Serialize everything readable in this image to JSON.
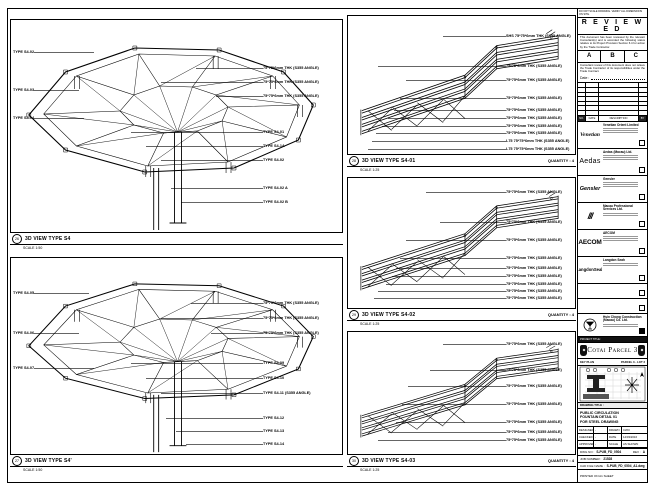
{
  "sheet_note": "DO NOT SCALE DRAWING. VERIFY ALL DIMENSIONS ON SITE.",
  "panels": {
    "big_top": {
      "bubble": "26",
      "caption": "3D VIEW TYPE S4",
      "scale": "SCALE 1:50",
      "left_labels": [
        "TYPE S4-02",
        "TYPE S4-03",
        "TYPE S4-04"
      ],
      "right_labels": [
        "75*75*6mm THK (S355 ANGLE)",
        "75*75*6mm THK (S355 ANGLE)",
        "75*75*6mm THK (S355 ANGLE)",
        "TYPE S4-01",
        "TYPE S4-1A",
        "TYPE S4-02",
        "TYPE S4-02 A",
        "TYPE S4-02 B"
      ]
    },
    "big_bottom": {
      "bubble": "27",
      "caption": "3D VIEW TYPE S4'",
      "scale": "SCALE 1:50",
      "left_labels": [
        "TYPE S4-05",
        "TYPE S4-06",
        "TYPE S4-07"
      ],
      "right_labels": [
        "75*75*6mm THK (S355 ANGLE)",
        "75*75*6mm THK (S355 ANGLE)",
        "75*75*6mm THK (S355 ANGLE)",
        "TYPE S4-09",
        "TYPE S4-10",
        "TYPE S4-11 (S355 ANGLE)",
        "TYPE S4-12",
        "TYPE S4-13",
        "TYPE S4-14"
      ]
    },
    "detail_1": {
      "bubble": "28",
      "caption": "3D VIEW TYPE S4-01",
      "scale": "SCALE 1:25",
      "quantity": "QUANTITY : 4",
      "labels": [
        "SHS 75*75*6mm THK (S355 ANGLE)",
        "75*75*6mm THK (S355 ANGLE)",
        "75*75*6mm THK (S355 ANGLE)",
        "75*75*6mm THK (S355 ANGLE)",
        "75*75*6mm THK (S355 ANGLE)",
        "75*75*6mm THK (S355 ANGLE)",
        "75*75*6mm THK (S355 ANGLE)",
        "75*75*6mm THK (S355 ANGLE)",
        "L75 75*75*6mm THK (S355 ANGLE)",
        "L75 75*75*6mm THK (S355 ANGLE)"
      ]
    },
    "detail_2": {
      "bubble": "29",
      "caption": "3D VIEW TYPE S4-02",
      "scale": "SCALE 1:25",
      "quantity": "QUANTITY : 4",
      "labels": [
        "75*75*6mm THK (S355 ANGLE)",
        "75*75*6mm THK (S355 ANGLE)",
        "75*75*6mm THK (S355 ANGLE)",
        "75*75*6mm THK (S355 ANGLE)",
        "75*75*6mm THK (S355 ANGLE)",
        "75*75*6mm THK (S355 ANGLE)",
        "75*75*6mm THK (S355 ANGLE)",
        "75*75*6mm THK (S355 ANGLE)",
        "75*75*6mm THK (S355 ANGLE)"
      ]
    },
    "detail_3": {
      "bubble": "30",
      "caption": "3D VIEW TYPE S4-03",
      "scale": "SCALE 1:25",
      "quantity": "QUANTITY : 4",
      "labels": [
        "75*75*6mm THK (S355 ANGLE)",
        "75*75*6mm THK (S355 ANGLE)",
        "75*75*6mm THK (S355 ANGLE)",
        "75*75*6mm THK (S355 ANGLE)",
        "75*75*6mm THK (S355 ANGLE)",
        "75*75*6mm THK (S355 ANGLE)",
        "75*75*6mm THK (S355 ANGLE)"
      ]
    }
  },
  "titleblock": {
    "reviewed": {
      "title": "R E V I E W E D",
      "para1": "This document has been reviewed by the relevant Consultant(s) and is accorded the following status relative to its Project Provision Section 6.4 for action by the Trade Contractor.",
      "cols": [
        "A",
        "B",
        "C"
      ],
      "para2": "Consultant review of this document does not relieve the Trade Contractor of its responsibilities under the Trade Contract.",
      "date_label": "Date :"
    },
    "rev_table": {
      "headers": [
        "NO.",
        "DATE",
        "DESCRIPTION",
        "BY"
      ]
    },
    "consultants": [
      {
        "logo": "Venetian",
        "name": "Venetian Orient Limited"
      },
      {
        "logo": "Aedas",
        "name": "Aedas (Macau) Ltd."
      },
      {
        "logo": "Gensler",
        "name": "Gensler"
      },
      {
        "logo": "///",
        "name": "Macau Professional Services Ltd."
      },
      {
        "logo": "AECOM",
        "name": "AECOM"
      },
      {
        "logo": "LangdonSeah",
        "name": "Langdon Seah"
      },
      {
        "logo": "",
        "name": ""
      },
      {
        "logo": "",
        "name": ""
      },
      {
        "logo": "HC",
        "name": "Hsin Chong Construction (Macau) Co. Ltd."
      }
    ],
    "project_title_label": "PROJECT TITLE :",
    "project_title": "Cotai Parcel 3",
    "key_plan": {
      "label": "KEY PLAN",
      "parcel": "PARCEL 3 - LOT 2"
    },
    "drawing_title_label": "DRAWING TITLE :",
    "drawing_title_lines": [
      "PUBLIC CIRCULATION",
      "FOUNTAIN DETAIL 01",
      "FOR STEEL DRAWING"
    ],
    "fields": {
      "designed_label": "DESIGNED",
      "designed": "-",
      "drawn_label": "DRAWN",
      "drawn": "CWO",
      "checked_label": "CHECKED",
      "checked": "-",
      "date_label": "DATE",
      "date": "14/03/2016",
      "approved_label": "APPROVED",
      "approved": "-",
      "scale_label": "SCALE",
      "scale": "AS SHOWN"
    },
    "dwg": {
      "label": "DWG NO :",
      "no": "S-PUB_FD_0504",
      "rev_label": "REV :",
      "rev": "A"
    },
    "job": {
      "label": "JOB NUMBER :",
      "no": "21528"
    },
    "cad": {
      "label": "CAD FILE NAME :",
      "name": "S-PUB_FD_0504_A1.dwg"
    },
    "print": {
      "label": "PRINTED ON A1 SHEET"
    }
  }
}
